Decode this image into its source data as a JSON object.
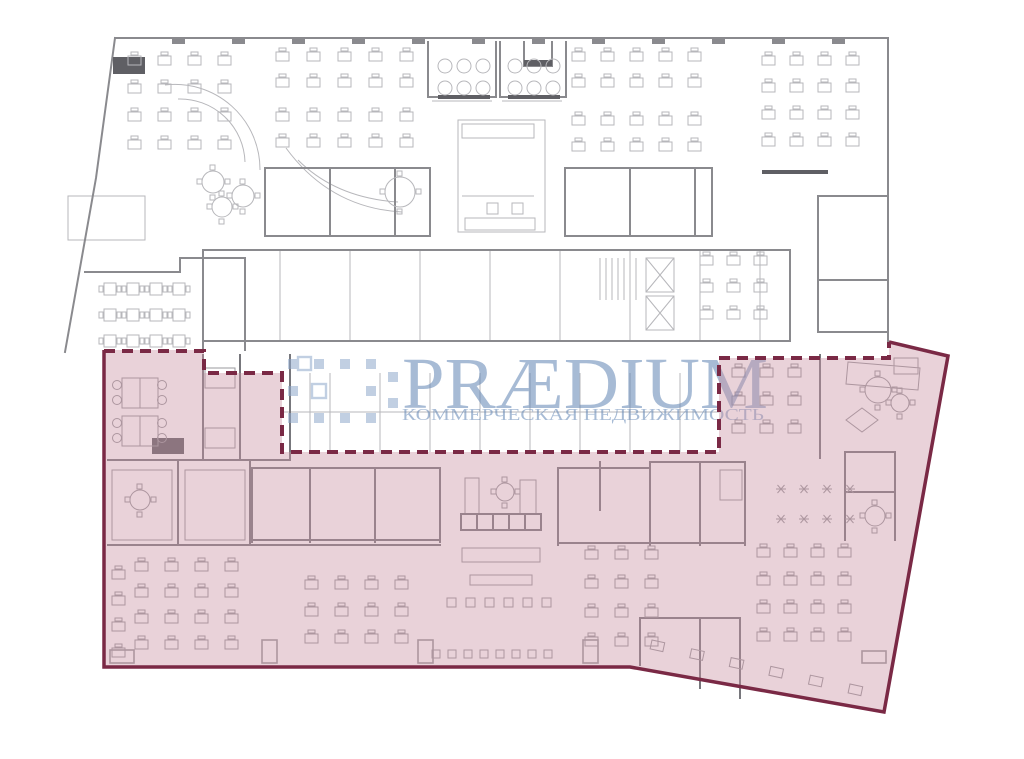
{
  "watermark": {
    "brand": "PRÆDIUM",
    "tagline": "КОММЕРЧЕСКАЯ НЕДВИЖИМОСТЬ",
    "text_color": "#6185B4",
    "logo_color": "#8FA9CC",
    "logo_squares": [
      [
        288,
        359
      ],
      [
        314,
        359
      ],
      [
        340,
        359
      ],
      [
        366,
        359
      ],
      [
        288,
        386
      ],
      [
        366,
        386
      ],
      [
        288,
        413
      ],
      [
        314,
        413
      ],
      [
        340,
        413
      ],
      [
        366,
        413
      ],
      [
        388,
        372
      ],
      [
        388,
        398
      ]
    ],
    "logo_outline_squares": [
      [
        312,
        384,
        14,
        14
      ],
      [
        298,
        357,
        13,
        13
      ]
    ]
  },
  "highlight": {
    "fill_color": "#CA94A4",
    "border_color": "#7A2945",
    "polygon_points": "104,350 204,350 204,373 282,373 282,452 719,452 719,358 889,358 889,342 948,356 884,712 630,667 104,667",
    "solid_border_path": "M889,342 L948,356 L884,712 L630,667 L104,667 L104,350",
    "dashed_border_path": "M104,351 H204 V373 H282 V452 H719 V358 H889 V342"
  },
  "plan": {
    "upper_light_color": "#B7B7BB",
    "upper_heavy_color": "#8A8A8E",
    "lower_light_color": "#98989C",
    "lower_heavy_color": "#77777C",
    "dark_color": "#5F5F64",
    "upper_heavy_d": "M115,38 H888 V341 M115,38 L96,178 L65,352 M203,250 H790 M203,250 V350 M203,341 H790 M790,250 V341 M265,168 H430 M265,168 V236 M430,168 V236 M265,236 H430 M330,168 V236 M395,168 V236 M565,168 H712 M565,168 V236 M712,168 V236 M565,236 H712 M630,168 V236 M695,168 V236 M428,42 V97 M496,42 V97 M500,42 V97 M566,42 V97 M428,97 H496 M500,97 H566 M818,196 H886 M818,196 V332 M818,280 H886 M818,332 H886 M85,272 H180 M180,258 H245 M180,258 V272 M245,258 V350 M524,42 V66 M524,66 H552 M552,42 V66",
    "upper_light_d": "M68,196 H145 V240 H68 Z M458,120 H545 V232 H458 Z M462,124 h72 v14 h-72 z M462,196 H534 M487,203 h11 v11 h-11 z M512,203 h11 v11 h-11 z M465,218 h70 v12 h-70 z M280,250 V341 M350,250 V341 M420,250 V341 M490,250 V341 M560,250 V341 M630,250 V341 M700,250 V341 M760,250 V341 M646,258 h28 v34 h-28 z M646,296 h28 v34 h-28 z M646,258 l28,34 M674,258 l-28,34 M646,296 l28,34 M674,296 l-28,34 M165,85 A85,85 0 0 1 260,170 M178,99 A65,65 0 0 1 245,162 M286,148 Q330,208 402,212 M298,160 Q336,198 398,202 M310,373 V452 M330,373 V452 M380,373 V452 M430,373 V452 M480,373 V452 M530,373 V452 M580,373 V452 M630,373 V452 M680,373 V452 M282,412 H719 M432,101 H492 M502,101 H562",
    "stair_hatch_d": "M600,258 V300 M606,258 V300 M612,258 V300 M618,258 V300 M624,258 V300 M630,258 V300 M636,258 V300",
    "lower_heavy_d": "M108,460 H290 M108,545 H440 M203,355 V460 M240,355 V460 M290,355 V460 M178,460 V545 M250,460 V545 M252,468 H440 M252,468 V542 M310,468 V542 M375,468 V542 M440,468 V542 M252,540 H440 M558,468 H650 M558,468 V545 M600,462 V510 M650,462 V545 M700,462 V545 M745,462 V545 M650,462 H745 M558,543 H745 M820,355 V458 M845,452 H895 M845,452 V540 M895,452 V540 M845,492 H895 M640,618 H740 M640,618 V665 M700,618 V688 M740,618 V698 M461,514 H541 V530 H461 Z M477,514 V530 M493,514 V530 M509,514 V530 M525,514 V530",
    "lower_light_d": "M465,478 h14 v36 h-14 z M520,480 h16 v34 h-16 z M462,548 h78 v14 h-78 z M470,575 h62 v10 h-62 z M848,362 L920,368 L918,390 L846,384 Z M862,408 L878,420 L862,432 L846,420 Z M894,358 h24 v16 h-24 z M205,368 h30 v20 h-30 z M205,428 h30 v20 h-30 z M112,470 h60 v70 h-60 z M185,470 h60 v70 h-60 z M720,470 h22 v30 h-22 z",
    "dark_rects": [
      [
        113,
        57,
        32,
        17
      ],
      [
        438,
        95,
        52,
        4
      ],
      [
        508,
        95,
        52,
        4
      ],
      [
        152,
        438,
        32,
        16
      ],
      [
        762,
        170,
        66,
        4
      ],
      [
        524,
        60,
        28,
        6
      ]
    ],
    "top_ticks": {
      "y": 38,
      "w": 13,
      "h": 6,
      "xs": [
        172,
        232,
        292,
        352,
        412,
        472,
        532,
        592,
        652,
        712,
        772,
        832
      ]
    },
    "desk_clusters": [
      {
        "x": 128,
        "y": 56,
        "cols": 4,
        "rows": 4,
        "dx": 30,
        "dy": 28,
        "layer": "upper"
      },
      {
        "x": 276,
        "y": 52,
        "cols": 5,
        "rows": 2,
        "dx": 31,
        "dy": 26,
        "layer": "upper"
      },
      {
        "x": 276,
        "y": 112,
        "cols": 5,
        "rows": 2,
        "dx": 31,
        "dy": 26,
        "layer": "upper"
      },
      {
        "x": 572,
        "y": 52,
        "cols": 5,
        "rows": 2,
        "dx": 29,
        "dy": 26,
        "layer": "upper"
      },
      {
        "x": 572,
        "y": 116,
        "cols": 5,
        "rows": 2,
        "dx": 29,
        "dy": 26,
        "layer": "upper"
      },
      {
        "x": 762,
        "y": 56,
        "cols": 4,
        "rows": 4,
        "dx": 28,
        "dy": 27,
        "layer": "upper"
      },
      {
        "x": 700,
        "y": 256,
        "cols": 3,
        "rows": 3,
        "dx": 27,
        "dy": 27,
        "layer": "upper"
      },
      {
        "x": 135,
        "y": 562,
        "cols": 4,
        "rows": 4,
        "dx": 30,
        "dy": 26,
        "layer": "lower"
      },
      {
        "x": 112,
        "y": 570,
        "cols": 1,
        "rows": 4,
        "dx": 0,
        "dy": 26,
        "layer": "lower"
      },
      {
        "x": 305,
        "y": 580,
        "cols": 4,
        "rows": 3,
        "dx": 30,
        "dy": 27,
        "layer": "lower"
      },
      {
        "x": 585,
        "y": 550,
        "cols": 3,
        "rows": 4,
        "dx": 30,
        "dy": 29,
        "layer": "lower"
      },
      {
        "x": 757,
        "y": 548,
        "cols": 4,
        "rows": 4,
        "dx": 27,
        "dy": 28,
        "layer": "lower"
      },
      {
        "x": 732,
        "y": 368,
        "cols": 3,
        "rows": 3,
        "dx": 28,
        "dy": 28,
        "layer": "lower"
      }
    ],
    "cafe_clusters": [
      {
        "x": 104,
        "y": 283,
        "cols": 4,
        "rows": 3,
        "dx": 23,
        "dy": 26,
        "layer": "upper"
      }
    ],
    "stool_rows": [
      {
        "x": 447,
        "y": 598,
        "cols": 6,
        "dx": 19,
        "s": 9,
        "layer": "lower"
      },
      {
        "x": 432,
        "y": 650,
        "cols": 8,
        "dx": 16,
        "s": 8,
        "layer": "lower"
      }
    ],
    "star_cluster": {
      "x": 781,
      "y": 489,
      "cols": 4,
      "dx": 23,
      "rows": 2,
      "dy": 30
    },
    "circle_rows": [
      {
        "x": 445,
        "y": 66,
        "n": 3,
        "dx": 19,
        "r": 7
      },
      {
        "x": 445,
        "y": 88,
        "n": 3,
        "dx": 19,
        "r": 7
      },
      {
        "x": 515,
        "y": 66,
        "n": 3,
        "dx": 19,
        "r": 7
      },
      {
        "x": 515,
        "y": 88,
        "n": 3,
        "dx": 19,
        "r": 7
      }
    ],
    "round_tables_upper": [
      [
        213,
        182,
        11
      ],
      [
        243,
        196,
        11
      ],
      [
        222,
        207,
        10
      ],
      [
        400,
        192,
        15
      ]
    ],
    "round_tables_lower": [
      [
        140,
        500,
        10
      ],
      [
        878,
        390,
        13
      ],
      [
        900,
        403,
        9
      ],
      [
        875,
        516,
        10
      ],
      [
        505,
        492,
        9
      ]
    ],
    "meeting_tables_lower": [
      [
        122,
        378
      ],
      [
        122,
        416
      ]
    ],
    "pilasters_lower": [
      [
        110,
        650,
        24,
        13
      ],
      [
        262,
        640,
        15,
        23
      ],
      [
        418,
        640,
        15,
        23
      ],
      [
        583,
        640,
        15,
        23
      ],
      [
        862,
        651,
        24,
        12
      ]
    ],
    "rot_desks": {
      "x1": 652,
      "y1": 640,
      "x2": 850,
      "y2": 684,
      "n": 6,
      "s": 13
    }
  }
}
